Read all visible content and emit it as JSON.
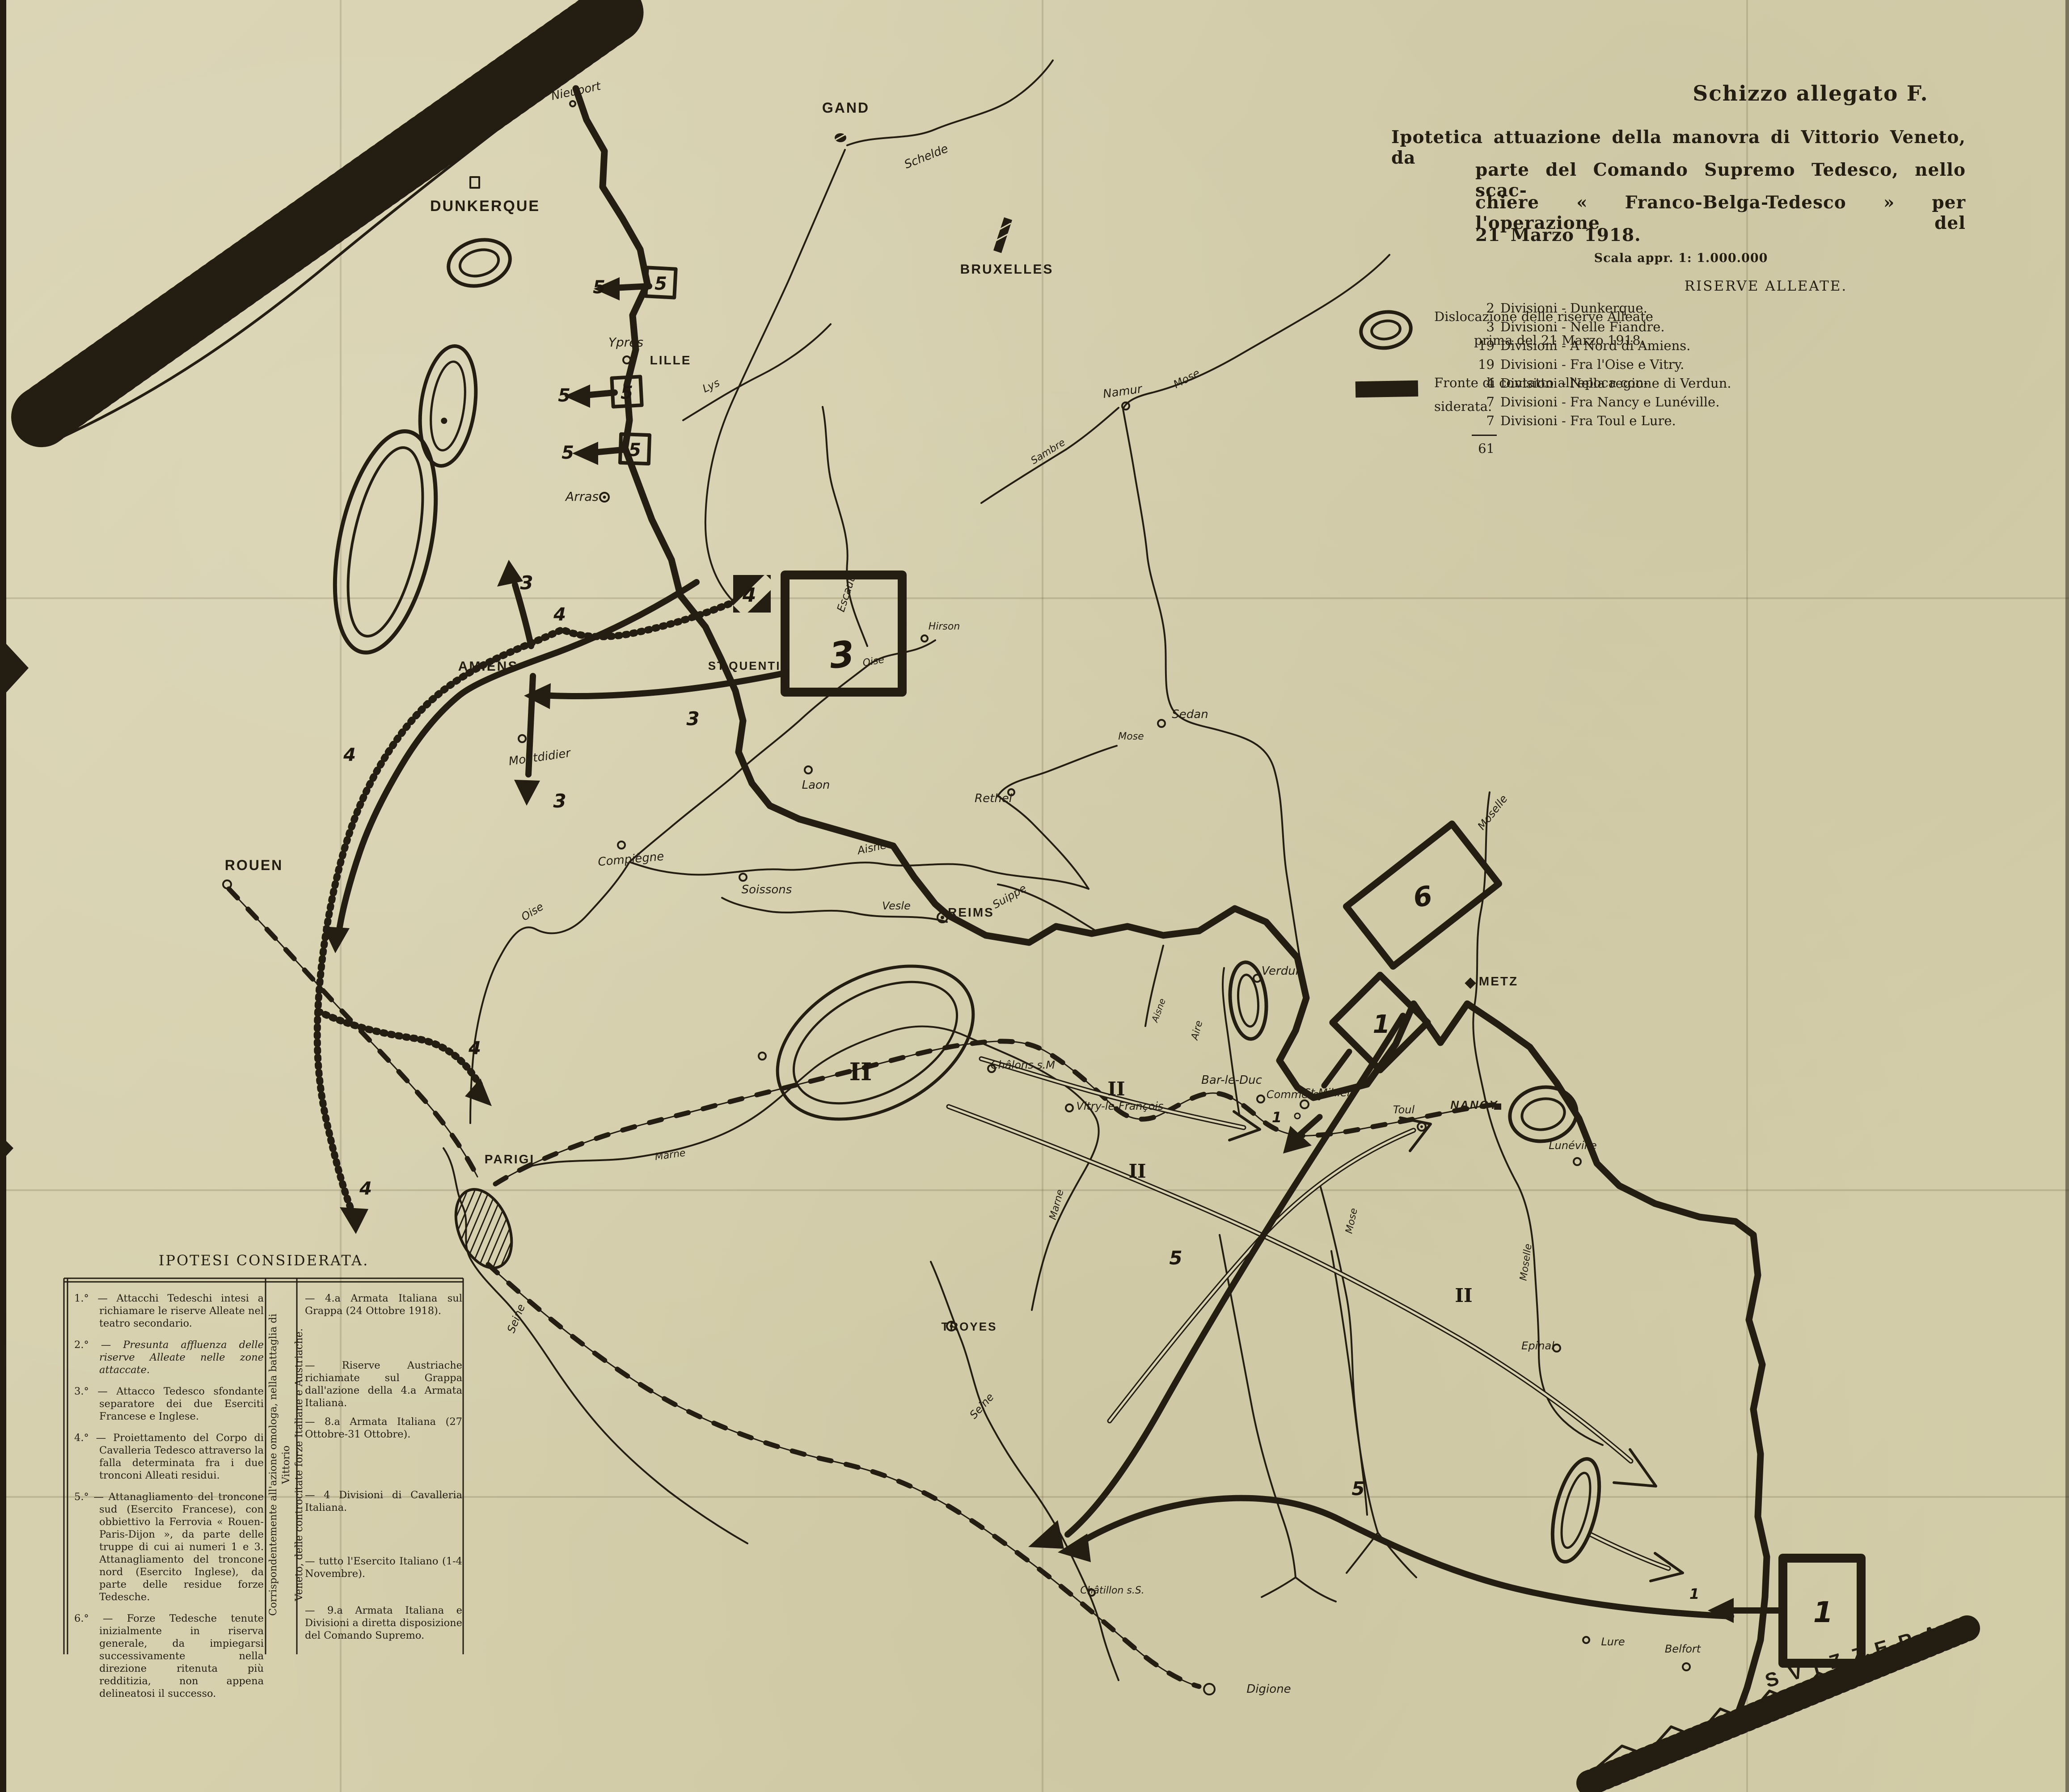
{
  "title": {
    "tag": "Schizzo allegato F.",
    "line1": "Ipotetica attuazione della manovra di Vittorio Veneto, da",
    "line2": "parte del Comando Supremo Tedesco, nello scac-",
    "line3": "chiere « Franco-Belga-Tedesco » per l'operazione del",
    "line4": "21 Marzo 1918.",
    "scale": "Scala appr. 1: 1.000.000"
  },
  "legend": {
    "reserves_line1": "Dislocazione delle riserve Alleate",
    "reserves_line2": "prima del 21 Marzo 1918.",
    "front_line1": "Fronte di contatto all'epoca con-",
    "front_line2": "siderata."
  },
  "reserves": {
    "title": "RISERVE ALLEATE.",
    "rows": [
      {
        "n": "2",
        "t": "Divisioni - Dunkerque."
      },
      {
        "n": "3",
        "t": "Divisioni - Nelle Fiandre."
      },
      {
        "n": "19",
        "t": "Divisioni - A Nord di Amiens."
      },
      {
        "n": "19",
        "t": "Divisioni - Fra l'Oise e Vitry."
      },
      {
        "n": "4",
        "t": "Divisioni - Nella regione di Verdun."
      },
      {
        "n": "7",
        "t": "Divisioni - Fra Nancy e Lunéville."
      },
      {
        "n": "7",
        "t": "Divisioni - Fra Toul e Lure."
      }
    ],
    "total": "61"
  },
  "hypotheses": {
    "title": "IPOTESI CONSIDERATA.",
    "left": [
      {
        "n": "1.°",
        "t": "— Attacchi Tedeschi intesi a richiamare le riserve Alleate nel teatro secondario."
      },
      {
        "n": "2.°",
        "t": "— Presunta affluenza delle riserve Alleate nelle zone attaccate."
      },
      {
        "n": "3.°",
        "t": "— Attacco Tedesco sfondante separatore dei due Eserciti Francese e Inglese."
      },
      {
        "n": "4.°",
        "t": "— Proiettamento del Corpo di Cavalleria Tedesco attraverso la falla determinata fra i due tronconi Alleati residui."
      },
      {
        "n": "5.°",
        "t": "— Attanagliamento del troncone sud (Esercito Francese), con obbiettivo la Ferrovia « Rouen-Paris-Dijon », da parte delle truppe di cui ai numeri 1 e 3. Attanagliamento del troncone nord (Esercito Inglese), da parte delle residue forze Tedesche."
      },
      {
        "n": "6.°",
        "t": "— Forze Tedesche tenute inizialmente in riserva generale, da impiegarsi successivamente nella direzione ritenuta più redditizia, non appena delineatosi il successo."
      }
    ],
    "middle_line1": "Corrispondentemente all'azione omologa, nella battaglia di Vittorio",
    "middle_line2": "Veneto, delle controcitate forze Italiane e Austriache.",
    "right": [
      "— 4.a Armata Italiana sul Grappa (24 Ottobre 1918).",
      "— Riserve Austriache richiamate sul Grappa dall'azione della 4.a Armata Italiana.",
      "— 8.a Armata Italiana (27 Ottobre-31 Ottobre).",
      "— 4 Divisioni di Cavalleria Italiana.",
      "— tutto l'Esercito Italiano (1-4 Novembre).",
      "— 9.a Armata Italiana e Divisioni a diretta disposizione del Comando Supremo."
    ]
  },
  "map": {
    "labels": [
      {
        "text": "DUNKERQUE"
      },
      {
        "text": "Nieuport"
      },
      {
        "text": "GAND"
      },
      {
        "text": "Ypres"
      },
      {
        "text": "LILLE"
      },
      {
        "text": "BRUXELLES"
      },
      {
        "text": "Schelde"
      },
      {
        "text": "Lys"
      },
      {
        "text": "Arras"
      },
      {
        "text": "Escaut"
      },
      {
        "text": "AMIENS"
      },
      {
        "text": "ST.QUENTIN"
      },
      {
        "text": "Hirson"
      },
      {
        "text": "Oise"
      },
      {
        "text": "Montdidier"
      },
      {
        "text": "Laon"
      },
      {
        "text": "Rethel"
      },
      {
        "text": "Compiègne"
      },
      {
        "text": "Soissons"
      },
      {
        "text": "Aisne"
      },
      {
        "text": "Vesle"
      },
      {
        "text": "Suippe"
      },
      {
        "text": "Oise"
      },
      {
        "text": "REIMS"
      },
      {
        "text": "Sedan"
      },
      {
        "text": "Mose"
      },
      {
        "text": "Namur"
      },
      {
        "text": "Sambre"
      },
      {
        "text": "Mose"
      },
      {
        "text": "Moselle"
      },
      {
        "text": "METZ"
      },
      {
        "text": "Verdun"
      },
      {
        "text": "Aire"
      },
      {
        "text": "St.Mihiel"
      },
      {
        "text": "Bar-le-Duc"
      },
      {
        "text": "Commercy"
      },
      {
        "text": "Châlons s.M"
      },
      {
        "text": "Marne"
      },
      {
        "text": "Vitry-le-François"
      },
      {
        "text": "Toul"
      },
      {
        "text": "NANCY"
      },
      {
        "text": "Lunéville"
      },
      {
        "text": "Mose"
      },
      {
        "text": "Moselle"
      },
      {
        "text": "Epinal"
      },
      {
        "text": "TROYES"
      },
      {
        "text": "Seine"
      },
      {
        "text": "Châtillon s.S."
      },
      {
        "text": "Seine"
      },
      {
        "text": "PARIGI"
      },
      {
        "text": "ROUEN"
      },
      {
        "text": "Lure"
      },
      {
        "text": "Belfort"
      },
      {
        "text": "SVIZZERA"
      },
      {
        "text": "Digione"
      },
      {
        "text": "Marne"
      },
      {
        "text": "Aisne"
      }
    ],
    "numbers": [
      {
        "text": "5"
      },
      {
        "text": "5"
      },
      {
        "text": "5"
      },
      {
        "text": "5"
      },
      {
        "text": "5"
      },
      {
        "text": "5"
      },
      {
        "text": "3"
      },
      {
        "text": "3"
      },
      {
        "text": "3"
      },
      {
        "text": "3"
      },
      {
        "text": "4"
      },
      {
        "text": "4"
      },
      {
        "text": "4"
      },
      {
        "text": "4"
      },
      {
        "text": "4"
      },
      {
        "text": "6"
      },
      {
        "text": "1"
      },
      {
        "text": "1"
      },
      {
        "text": "1"
      },
      {
        "text": "1"
      },
      {
        "text": "II"
      },
      {
        "text": "II"
      },
      {
        "text": "II"
      },
      {
        "text": "II"
      },
      {
        "text": "5"
      },
      {
        "text": "5"
      }
    ]
  }
}
